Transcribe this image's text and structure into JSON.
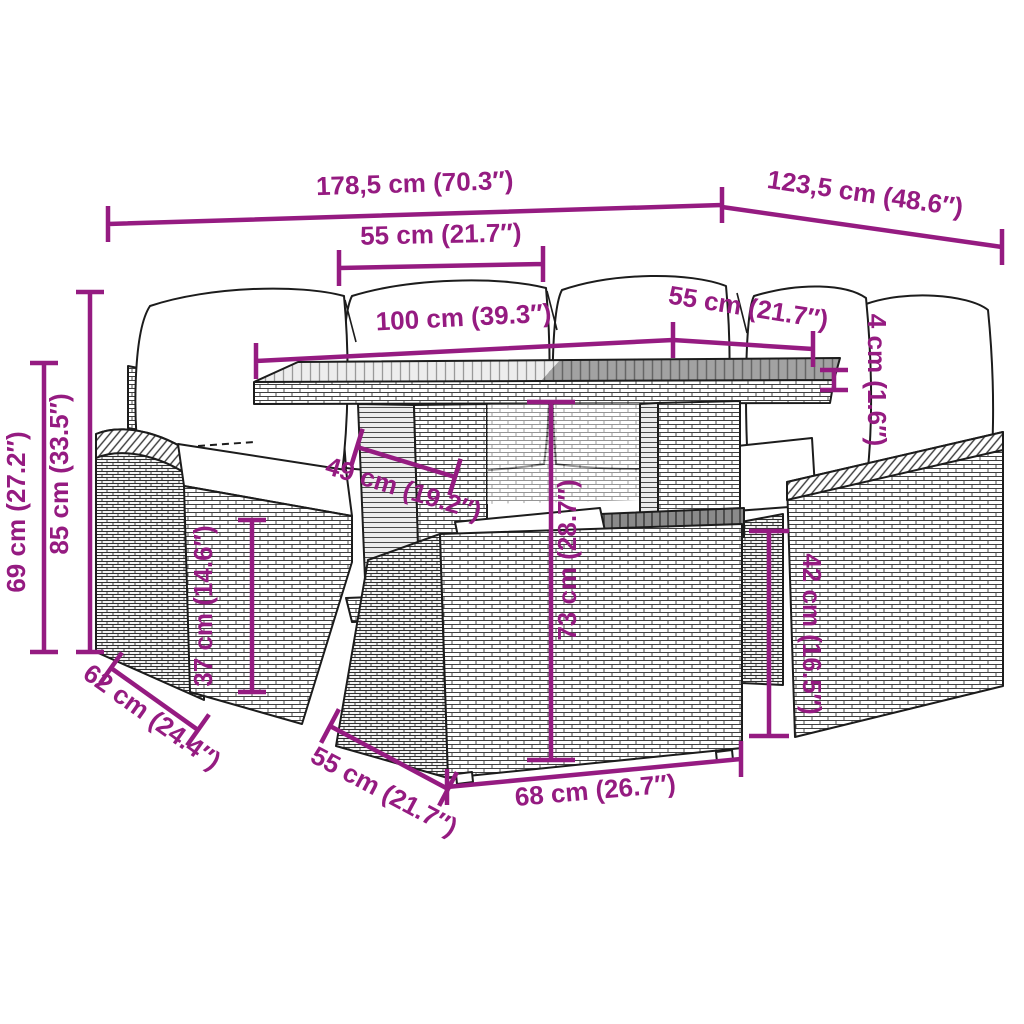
{
  "diagram": {
    "type": "product-dimension-diagram",
    "subject": "poly rattan garden lounge set with slat-top table and ottoman",
    "style": "black line-art illustration with magenta dimension annotations on white background",
    "colors": {
      "accent": "#951B81",
      "outline": "#1c1c1c",
      "background": "#ffffff",
      "tabletop_light": "#ededed",
      "tabletop_dark": "#a2a2a2"
    },
    "dimensions": [
      {
        "id": "overall-width",
        "text": "178,5 cm (70.3″)",
        "cm": "178,5",
        "inches": "70.3",
        "meaning": "total width of the set"
      },
      {
        "id": "overall-depth",
        "text": "123,5 cm (48.6″)",
        "cm": "123,5",
        "inches": "48.6",
        "meaning": "total depth of the set"
      },
      {
        "id": "left-seat-width",
        "text": "55 cm (21.7″)",
        "cm": "55",
        "inches": "21.7",
        "meaning": "seat cushion width, left sofa"
      },
      {
        "id": "table-length",
        "text": "100 cm (39.3″)",
        "cm": "100",
        "inches": "39.3",
        "meaning": "table length"
      },
      {
        "id": "right-seat-width",
        "text": "55 cm (21.7″)",
        "cm": "55",
        "inches": "21.7",
        "meaning": "table depth / right seat width"
      },
      {
        "id": "tabletop-thickness",
        "text": "4 cm (1.6″)",
        "cm": "4",
        "inches": "1.6",
        "meaning": "tabletop thickness"
      },
      {
        "id": "total-height",
        "text": "85 cm (33.5″)",
        "cm": "85",
        "inches": "33.5",
        "meaning": "total height incl. back cushions"
      },
      {
        "id": "frame-height",
        "text": "69 cm (27.2″)",
        "cm": "69",
        "inches": "27.2",
        "meaning": "height of backrest frame"
      },
      {
        "id": "seat-height",
        "text": "37 cm (14.6″)",
        "cm": "37",
        "inches": "14.6",
        "meaning": "seat height from ground"
      },
      {
        "id": "table-base-depth",
        "text": "49 cm (19.2″)",
        "cm": "49",
        "inches": "19.2",
        "meaning": "table pedestal depth"
      },
      {
        "id": "table-height",
        "text": "73 cm (28.7″)",
        "cm": "73",
        "inches": "28.7",
        "meaning": "table height"
      },
      {
        "id": "ottoman-height",
        "text": "42 cm (16.5″)",
        "cm": "42",
        "inches": "16.5",
        "meaning": "ottoman height"
      },
      {
        "id": "seat-depth",
        "text": "62 cm (24.4″)",
        "cm": "62",
        "inches": "24.4",
        "meaning": "sofa seat depth"
      },
      {
        "id": "ottoman-depth",
        "text": "55 cm (21.7″)",
        "cm": "55",
        "inches": "21.7",
        "meaning": "ottoman depth"
      },
      {
        "id": "ottoman-width",
        "text": "68 cm (26.7″)",
        "cm": "68",
        "inches": "26.7",
        "meaning": "ottoman width"
      }
    ]
  }
}
